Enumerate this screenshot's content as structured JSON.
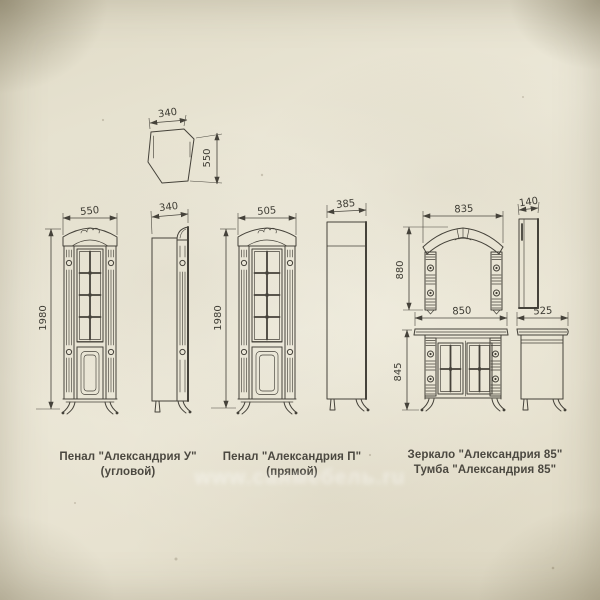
{
  "colors": {
    "paper": "#e9e5d4",
    "ink": "#45423a",
    "dim_text": "#3e3c34"
  },
  "top_view": {
    "width_label": "340",
    "depth_label": "550"
  },
  "corner_cabinet": {
    "caption_line1": "Пенал \"Александрия У\"",
    "caption_line2": "(угловой)",
    "front_width": "550",
    "height": "1980",
    "side_depth": "340"
  },
  "straight_cabinet": {
    "caption_line1": "Пенал \"Александрия П\"",
    "caption_line2": "(прямой)",
    "front_width": "505",
    "height": "1980",
    "side_depth": "385"
  },
  "mirror": {
    "caption": "Зеркало \"Александрия 85\"",
    "width": "835",
    "height": "880",
    "side_depth": "140"
  },
  "vanity": {
    "caption": "Тумба \"Александрия 85\"",
    "width": "850",
    "height": "845",
    "side_depth": "525"
  },
  "watermark": {
    "text": "www.санмебель.ru"
  }
}
